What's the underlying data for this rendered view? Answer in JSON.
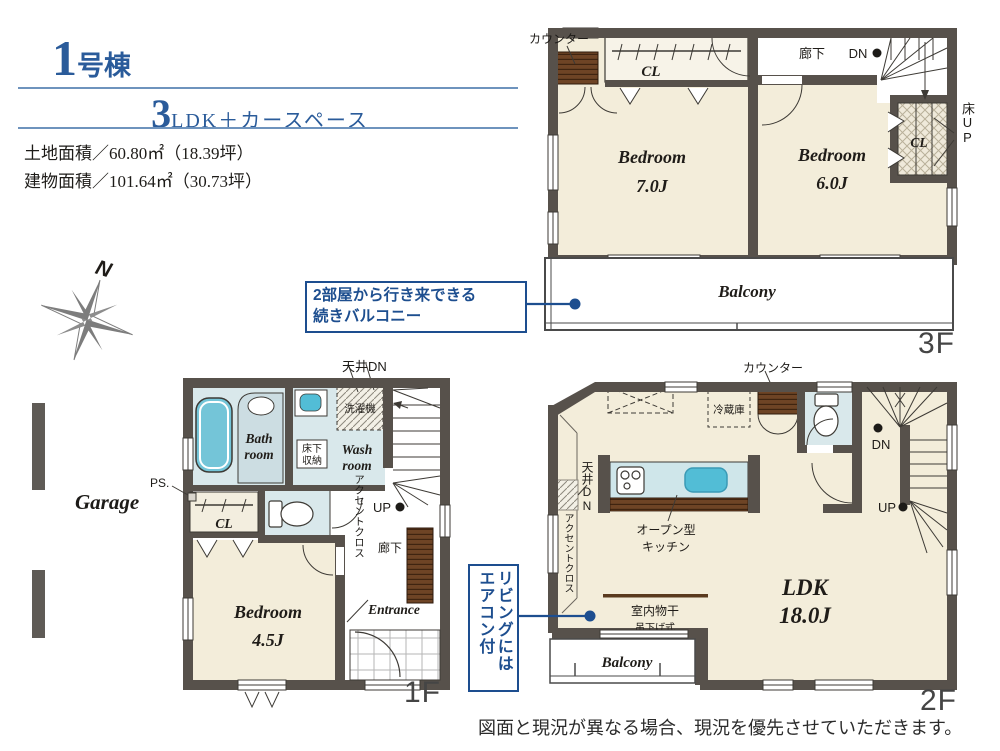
{
  "header": {
    "building_number": "1",
    "building_suffix": "号棟",
    "layout_prefix": "3",
    "layout_suffix": "LDK＋カースペース",
    "land_area": "土地面積／60.80㎡（18.39坪）",
    "building_area": "建物面積／101.64㎡（30.73坪）"
  },
  "compass": {
    "north": "N"
  },
  "callouts": {
    "balcony_line1": "2部屋から行き来できる",
    "balcony_line2": "続きバルコニー",
    "aircon_col1": "リビングには",
    "aircon_col2": "エアコン付"
  },
  "floor3": {
    "tag": "3F",
    "labels": {
      "counter": "カウンター",
      "closet": "CL",
      "hallway": "廊下",
      "down": "DN",
      "closet2": "CL",
      "floor_up": "床UP",
      "bedroom1_name": "Bedroom",
      "bedroom1_size": "7.0J",
      "bedroom2_name": "Bedroom",
      "bedroom2_size": "6.0J",
      "balcony": "Balcony"
    }
  },
  "floor1": {
    "tag": "1F",
    "labels": {
      "ceiling_down": "天井DN",
      "washing_machine": "洗濯機",
      "bath_line1": "Bath",
      "bath_line2": "room",
      "underfloor_line1": "床下",
      "underfloor_line2": "収納",
      "wash_line1": "Wash",
      "wash_line2": "room",
      "ps": "PS.",
      "closet": "CL",
      "accent_cloth": "アクセントクロス",
      "up": "UP",
      "hallway": "廊下",
      "bedroom_name": "Bedroom",
      "bedroom_size": "4.5J",
      "entrance": "Entrance",
      "garage": "Garage"
    }
  },
  "floor2": {
    "tag": "2F",
    "labels": {
      "counter": "カウンター",
      "fridge": "冷蔵庫",
      "ceiling_down": "天井DN",
      "accent_cloth": "アクセントクロス",
      "kitchen_line1": "オープン型",
      "kitchen_line2": "キッチン",
      "down": "DN",
      "up": "UP",
      "drying_line1": "室内物干",
      "drying_line2": "吊下げ式",
      "ldk_name": "LDK",
      "ldk_size": "18.0J",
      "balcony": "Balcony"
    }
  },
  "footer": {
    "disclaimer": "図面と現況が異なる場合、現況を優先させていただきます。"
  },
  "colors": {
    "wall": "#57514b",
    "floor_cream": "#f3edda",
    "wet_room_blue": "#d9e8eb",
    "fixture_blue": "#74c5d8",
    "sink_blue": "#52bdd6",
    "wood_brown": "#6e4425",
    "accent_blue": "#1d4e8f",
    "title_blue": "#2a5b9a"
  }
}
